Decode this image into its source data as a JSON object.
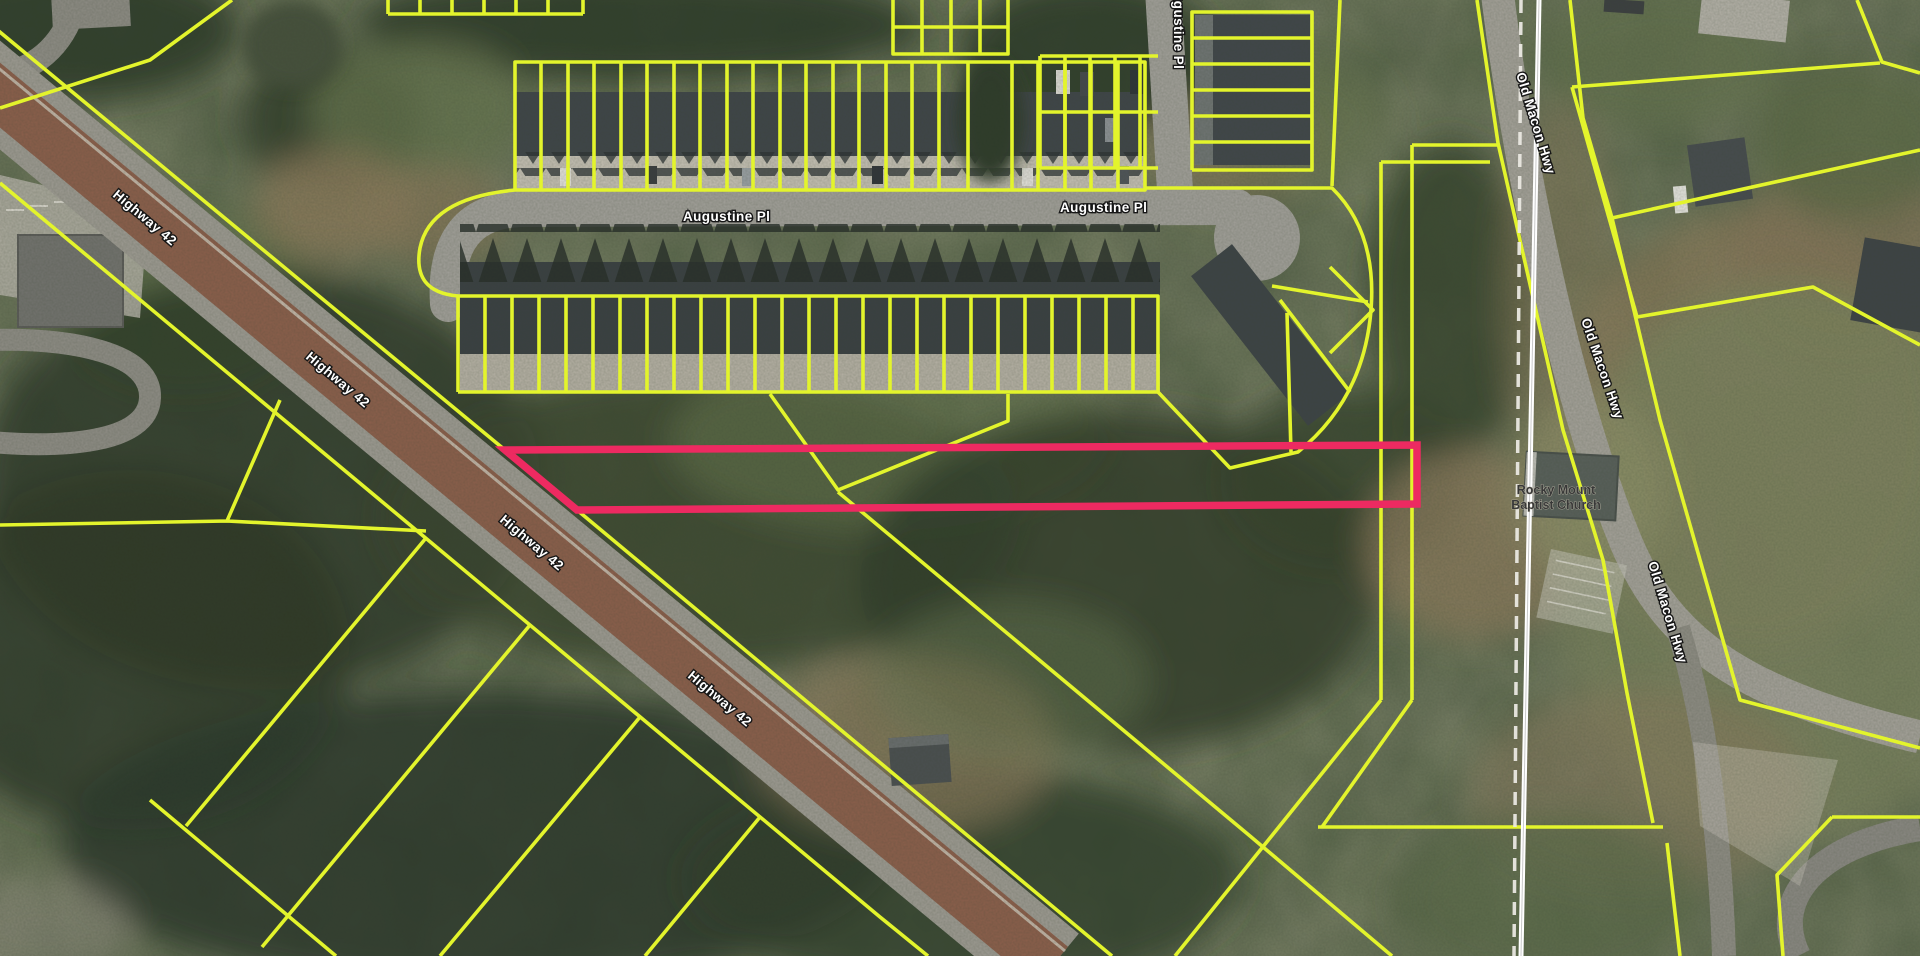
{
  "map": {
    "view_type": "aerial-parcel-map",
    "roads": {
      "highway": {
        "name": "Highway 42",
        "label_occurrences": 4
      },
      "augustine": {
        "name": "Augustine Pl",
        "label_occurrences": 3
      },
      "old_macon": {
        "name": "Old Macon Hwy",
        "label_occurrences": 3
      }
    },
    "poi": {
      "church": {
        "name_line1": "Rocky Mount",
        "name_line2": "Baptist Church"
      }
    },
    "selected_parcel": {
      "highlighted": true,
      "outline_color": "#ed2a61"
    },
    "colors": {
      "parcel_line": "#e3f42c",
      "selected_parcel": "#ed2a61",
      "road_label_fill": "#ffffff",
      "road_label_halo": "#161616",
      "poi_label_fill": "#383838",
      "highway_overlay": "#8a5742",
      "road_surface": "#a3a19b",
      "railroad_line": "#ffffff",
      "boundary_dash_line": "#eae8e1"
    }
  }
}
